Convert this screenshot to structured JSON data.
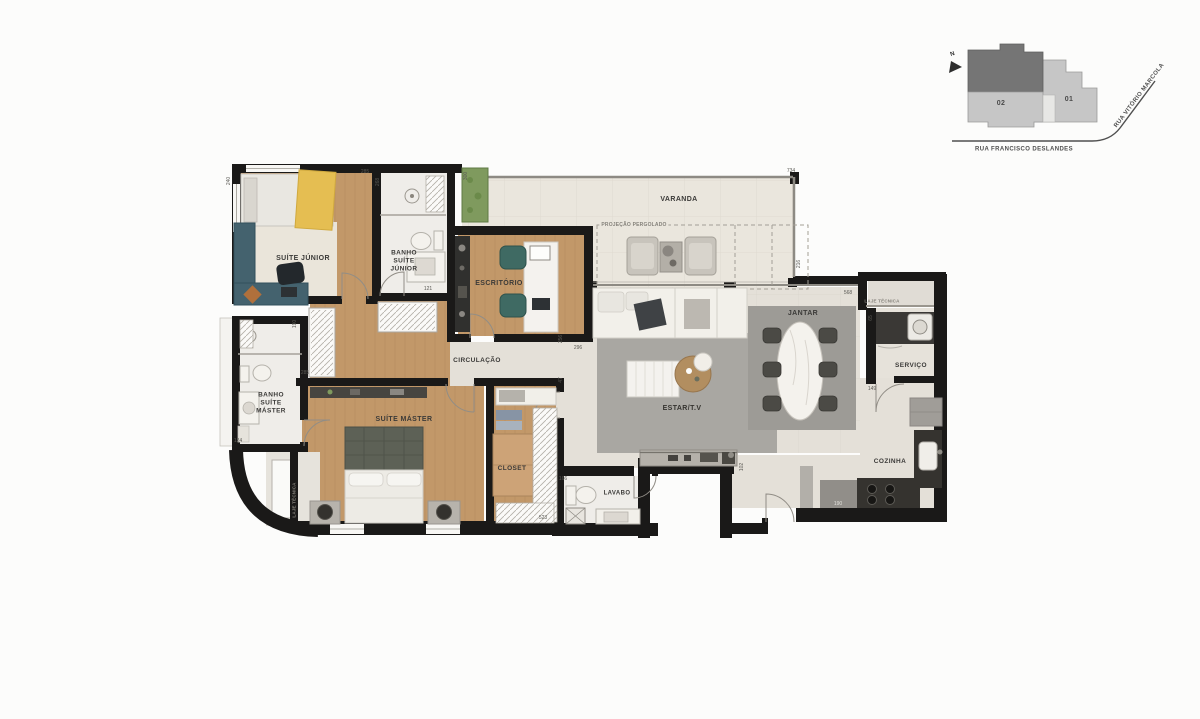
{
  "plan": {
    "rooms": {
      "suite_junior": "SUÍTE JÚNIOR",
      "banho_suite_junior": "BANHO SUÍTE JÚNIOR",
      "escritorio": "ESCRITÓRIO",
      "varanda": "VARANDA",
      "projecao_pergolado": "PROJEÇÃO PERGOLADO",
      "circulacao": "CIRCULAÇÃO",
      "banho_suite_master": "BANHO SUÍTE MÁSTER",
      "suite_master": "SUÍTE MÁSTER",
      "closet": "CLOSET",
      "lavabo": "LAVABO",
      "estar_tv": "ESTAR/T.V",
      "jantar": "JANTAR",
      "servico": "SERVIÇO",
      "cozinha": "COZINHA",
      "laje_tecnica": "LAJE TÉCNICA"
    },
    "dimensions": [
      "240",
      "285",
      "268",
      "300",
      "734",
      "216",
      "296",
      "568",
      "121",
      "190",
      "285",
      "124",
      "65",
      "149",
      "190",
      "166",
      "102",
      "523",
      "256",
      "47"
    ]
  },
  "site_plan": {
    "north_label": "N",
    "building_02": "02",
    "building_01": "01",
    "street_bottom": "RUA FRANCISCO DESLANDES",
    "street_right": "RUA VITÓRIO MARCOLA"
  },
  "colors": {
    "wall": "#1a1918",
    "wood_floor": "#c29869",
    "social_floor": "#e4e0d8",
    "varanda_floor": "#eae6dd",
    "bath_floor": "#efede9",
    "rug": "#a8a6a1",
    "desk_teal": "#44626e",
    "throw_yellow": "#e5be52",
    "counter_dark": "#35332f",
    "planter_green": "#7f9a5e",
    "site_dark": "#757575",
    "site_light": "#c6c6c6"
  }
}
